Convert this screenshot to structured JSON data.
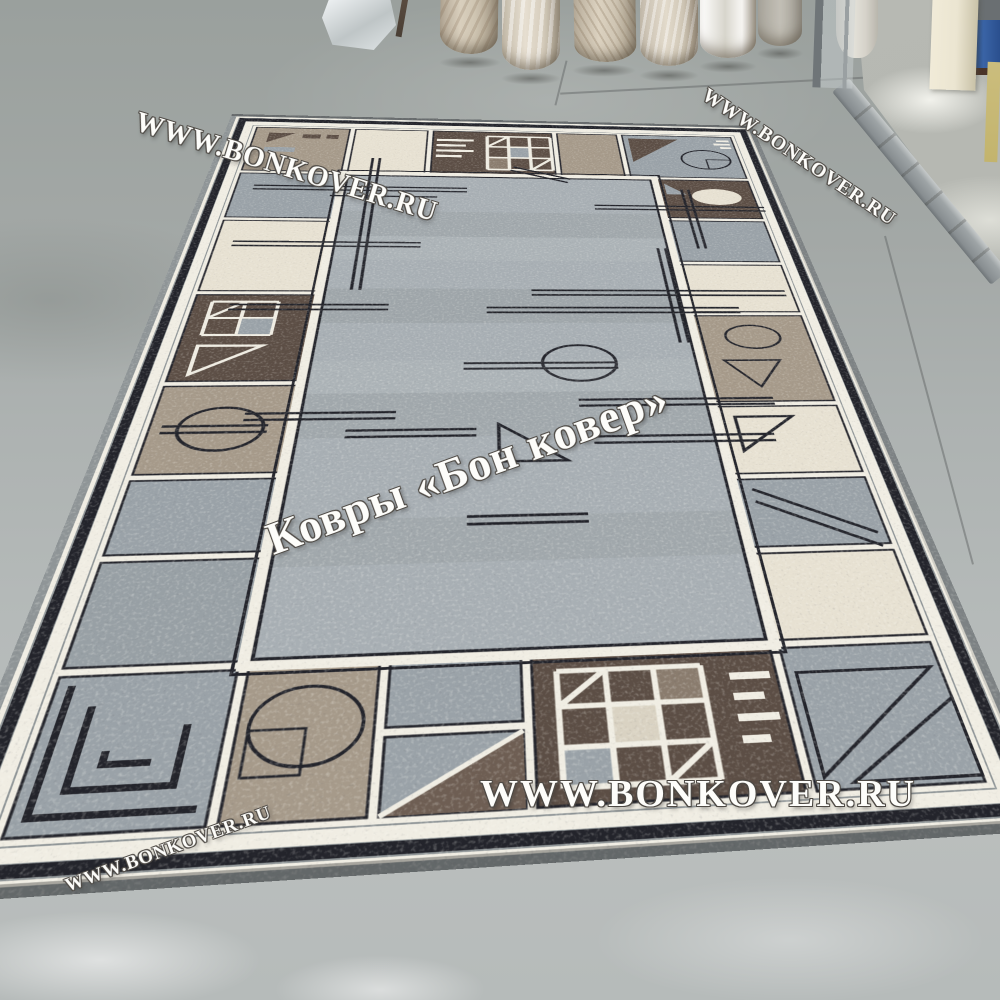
{
  "watermarks": {
    "site_url": "WWW.BONKOVER.RU",
    "brand_label": "Ковры «Бон ковер»"
  },
  "colors": {
    "floor_back": "#9aa09d",
    "floor_front": "#b5bab9",
    "concrete_outside": "#b4b6b0",
    "rug_field": "#a8afb4",
    "rug_gray": "#9aa2a8",
    "rug_cream": "#e7e1d2",
    "rug_brown": "#5c4e45",
    "rug_brown_mid": "#6e5e53",
    "rug_taupe": "#a69a8a",
    "rug_line_dark": "#23242b",
    "rug_line_white": "#f0ede3",
    "rug_binding": "#8f9597",
    "blue_box": "#3a64a6",
    "door_post": "#ebe5d1",
    "wall_strip": "#c3b46d",
    "watermark_ink": "#fdfdfa",
    "watermark_outline": "#4e4a45"
  }
}
